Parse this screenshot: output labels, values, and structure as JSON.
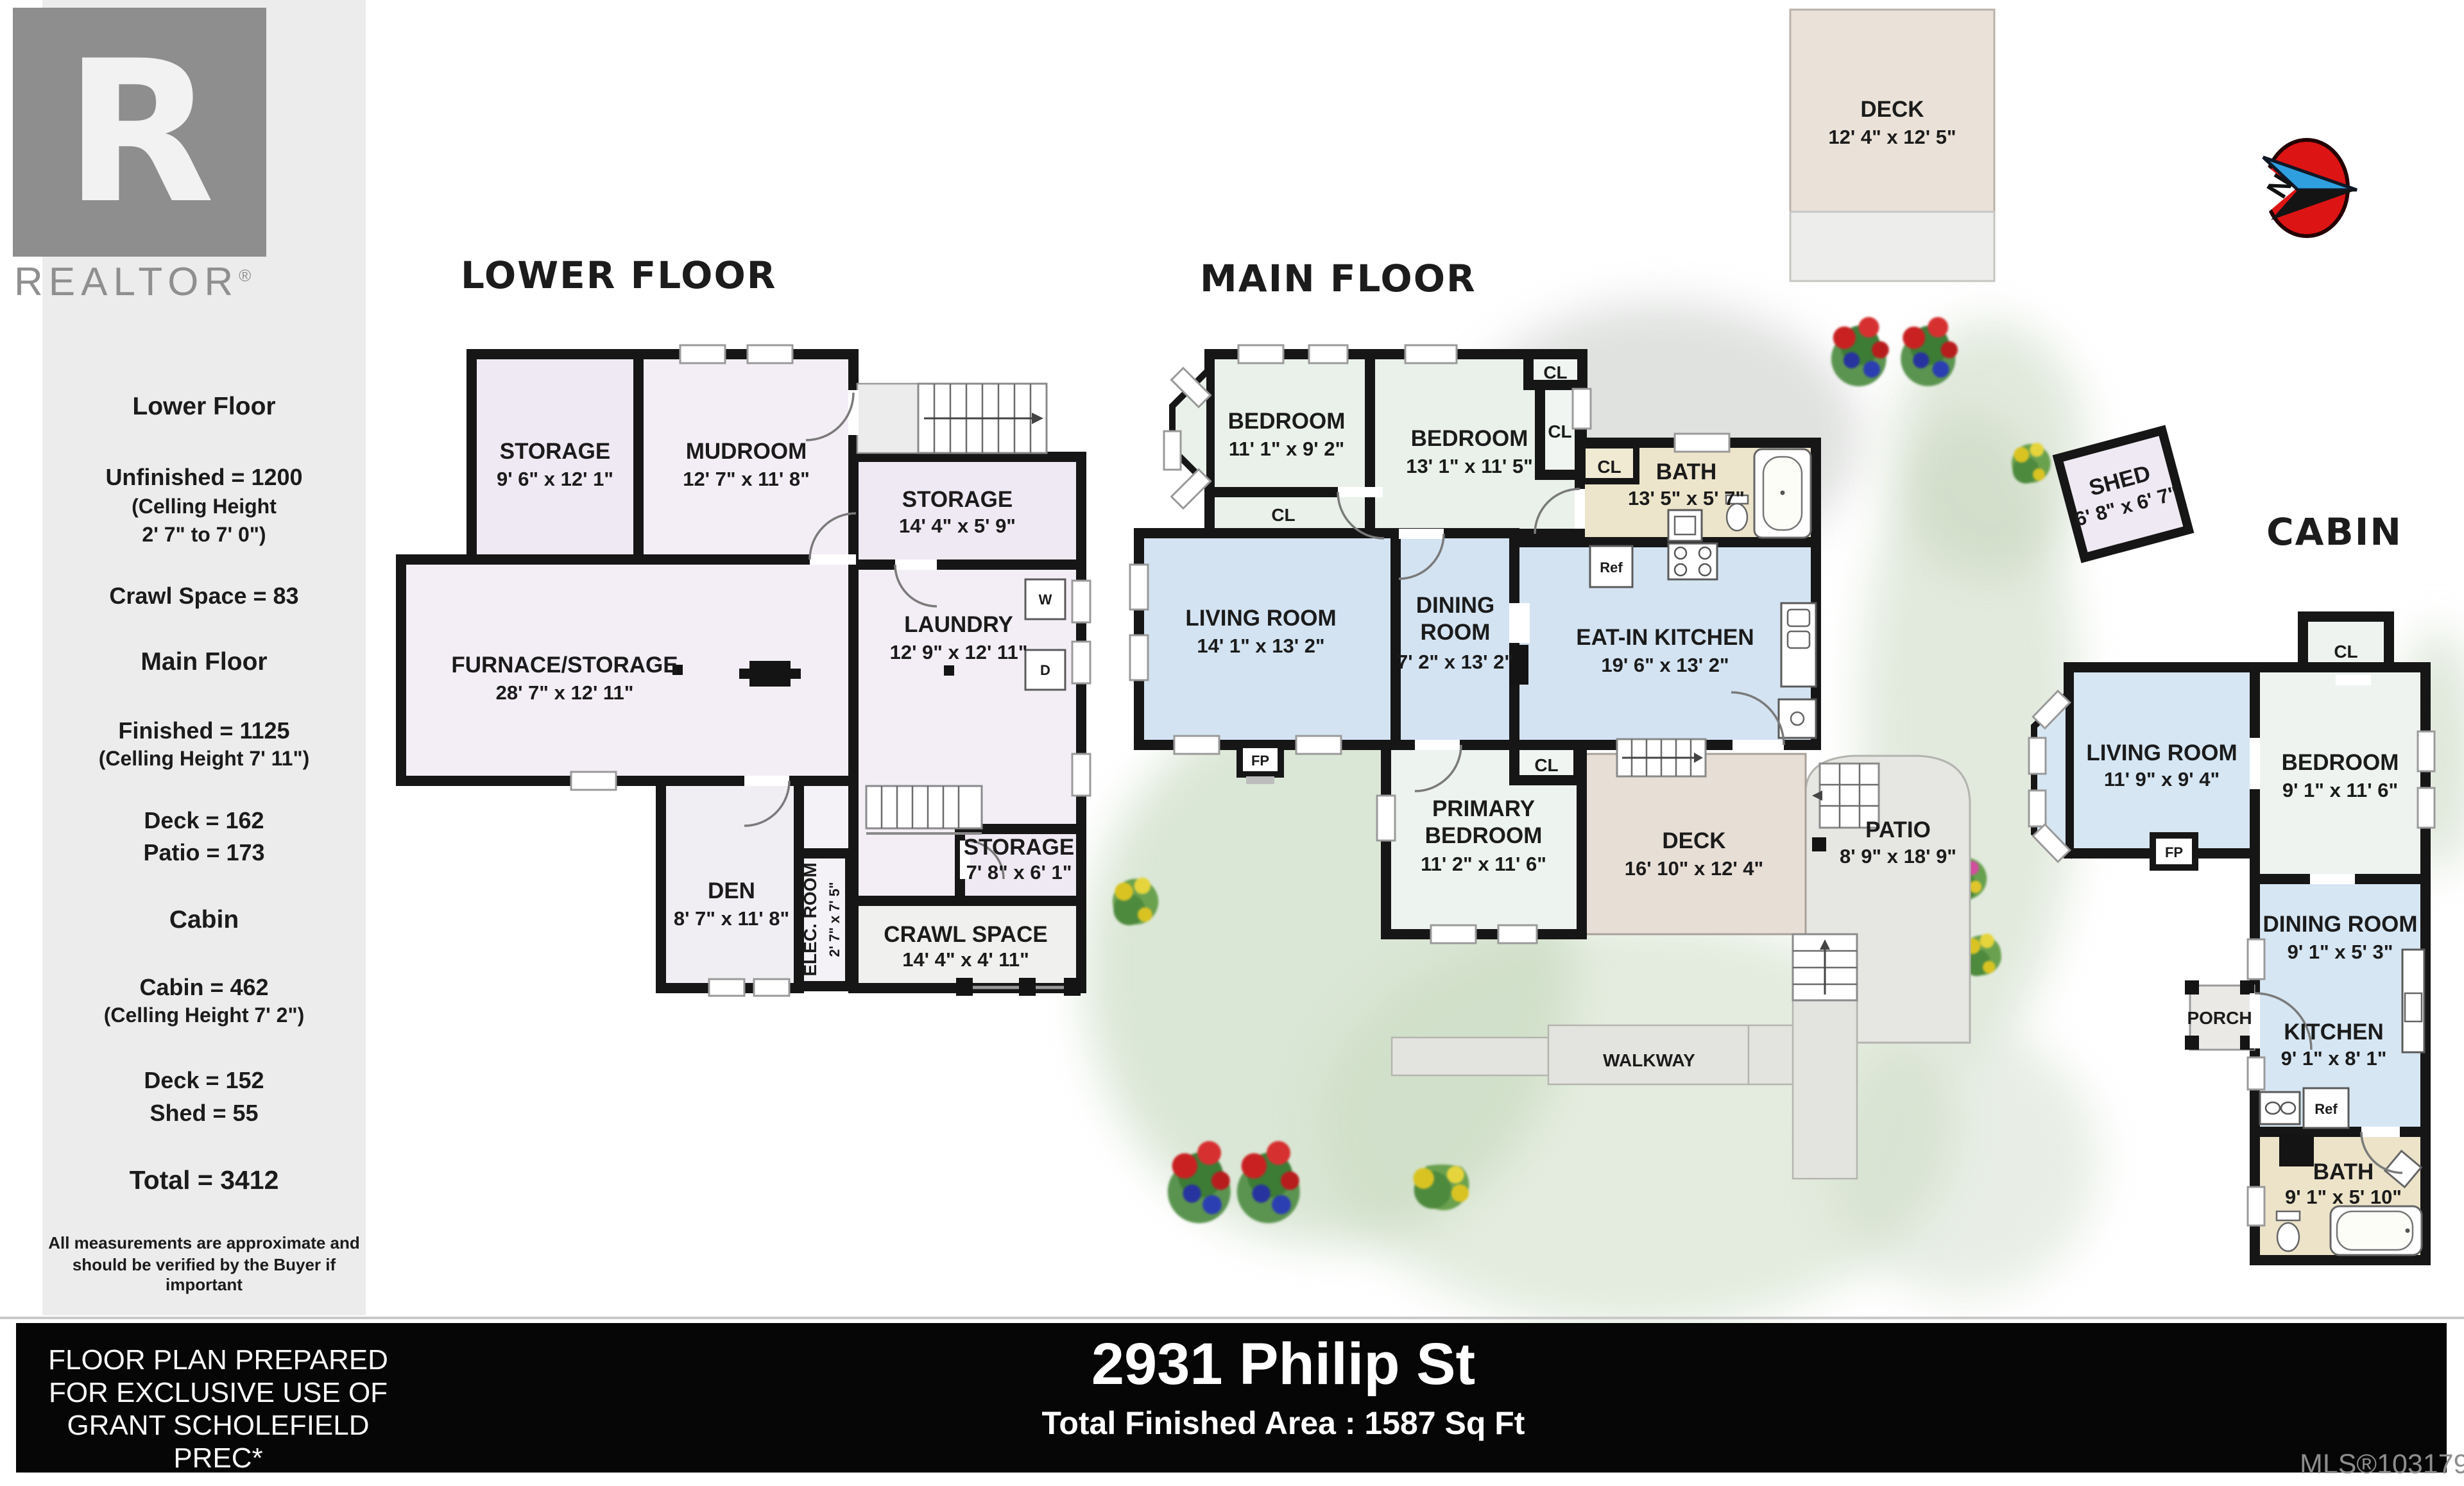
{
  "branding": {
    "logo_letter": "R",
    "logo_text": "REALTOR",
    "registered": "®"
  },
  "sidebar": {
    "lower": {
      "title": "Lower Floor",
      "unfinished": "Unfinished = 1200",
      "ceiling1": "(Celling Height",
      "ceiling2": "2' 7\" to 7' 0\")",
      "crawl": "Crawl Space = 83"
    },
    "main": {
      "title": "Main Floor",
      "finished": "Finished = 1125",
      "ceiling": "(Celling Height 7' 11\")",
      "deck": "Deck = 162",
      "patio": "Patio = 173"
    },
    "cabin": {
      "title": "Cabin",
      "cabin": "Cabin = 462",
      "ceiling": "(Celling Height 7' 2\")",
      "deck": "Deck = 152",
      "shed": "Shed = 55"
    },
    "total": "Total = 3412",
    "disclaimer1": "All measurements are approximate and",
    "disclaimer2": "should be verified by the Buyer if important"
  },
  "titles": {
    "lower": "LOWER FLOOR",
    "main": "MAIN FLOOR",
    "cabin": "CABIN"
  },
  "labels": {
    "cl": "CL",
    "fp": "FP",
    "ref": "Ref",
    "w": "W",
    "d": "D"
  },
  "lower_floor": {
    "storage1": {
      "name": "STORAGE",
      "dims": "9' 6\" x 12' 1\""
    },
    "mudroom": {
      "name": "MUDROOM",
      "dims": "12' 7\" x 11' 8\""
    },
    "storage2": {
      "name": "STORAGE",
      "dims": "14' 4\" x 5' 9\""
    },
    "furnace": {
      "name": "FURNACE/STORAGE",
      "dims": "28' 7\" x 12' 11\""
    },
    "laundry": {
      "name": "LAUNDRY",
      "dims": "12' 9\" x 12' 11\""
    },
    "den": {
      "name": "DEN",
      "dims": "8' 7\" x 11' 8\""
    },
    "elec": {
      "name": "ELEC. ROOM",
      "dims": "2' 7\" x 7' 5\""
    },
    "storage3": {
      "name": "STORAGE",
      "dims": "7' 8\" x 6' 1\""
    },
    "crawl": {
      "name": "CRAWL SPACE",
      "dims": "14' 4\" x 4' 11\""
    }
  },
  "main_floor": {
    "bedroom1": {
      "name": "BEDROOM",
      "dims": "11' 1\" x 9' 2\""
    },
    "bedroom2": {
      "name": "BEDROOM",
      "dims": "13' 1\" x 11' 5\""
    },
    "bath": {
      "name": "BATH",
      "dims": "13' 5\" x 5' 7\""
    },
    "living": {
      "name": "LIVING ROOM",
      "dims": "14' 1\" x 13' 2\""
    },
    "dining": {
      "line1": "DINING",
      "line2": "ROOM",
      "dims": "7' 2\" x 13' 2\""
    },
    "kitchen": {
      "name": "EAT-IN KITCHEN",
      "dims": "19' 6\" x 13' 2\""
    },
    "primary": {
      "line1": "PRIMARY",
      "line2": "BEDROOM",
      "dims": "11' 2\" x 11' 6\""
    },
    "deck": {
      "name": "DECK",
      "dims": "16' 10\" x 12' 4\""
    },
    "patio": {
      "name": "PATIO",
      "dims": "8' 9\" x 18' 9\""
    },
    "walkway": "WALKWAY"
  },
  "upper_deck": {
    "name": "DECK",
    "dims": "12' 4\" x 12' 5\""
  },
  "compass": {
    "north": "N"
  },
  "cabin": {
    "shed": {
      "name": "SHED",
      "dims": "6' 8\" x 6' 7\""
    },
    "living": {
      "name": "LIVING ROOM",
      "dims": "11' 9\" x 9' 4\""
    },
    "bedroom": {
      "name": "BEDROOM",
      "dims": "9' 1\" x 11' 6\""
    },
    "dining": {
      "name": "DINING ROOM",
      "dims": "9' 1\" x 5' 3\""
    },
    "porch": "PORCH",
    "kitchen": {
      "name": "KITCHEN",
      "dims": "9' 1\" x 8' 1\""
    },
    "bath": {
      "name": "BATH",
      "dims": "9' 1\" x 5' 10\""
    }
  },
  "footer": {
    "prepared_line1": "FLOOR PLAN PREPARED",
    "prepared_line2": "FOR EXCLUSIVE USE OF",
    "prepared_line3": "GRANT SCHOLEFIELD PREC*",
    "address": "2931 Philip St",
    "total_area": "Total Finished Area : 1587 Sq Ft",
    "mls": "MLS®1031793"
  },
  "colors": {
    "storage_fill": "#efe9f3",
    "storage_fill2": "#f3eef6",
    "bedroom_fill": "#e9f1ea",
    "living_fill": "#d3e3f2",
    "bath_fill": "#ede5cb",
    "primary_fill": "#edf3ee",
    "deck_fill": "#e7ded6",
    "patio_fill": "#e6e6e3",
    "cabin_blue": "#d6e6f3",
    "cabin_bedroom": "#eef3ef",
    "cabin_bath": "#ece3c9",
    "upper_deck_fill": "#eae2d8",
    "compass_red": "#dd1414",
    "compass_blue": "#2f9fe0"
  }
}
